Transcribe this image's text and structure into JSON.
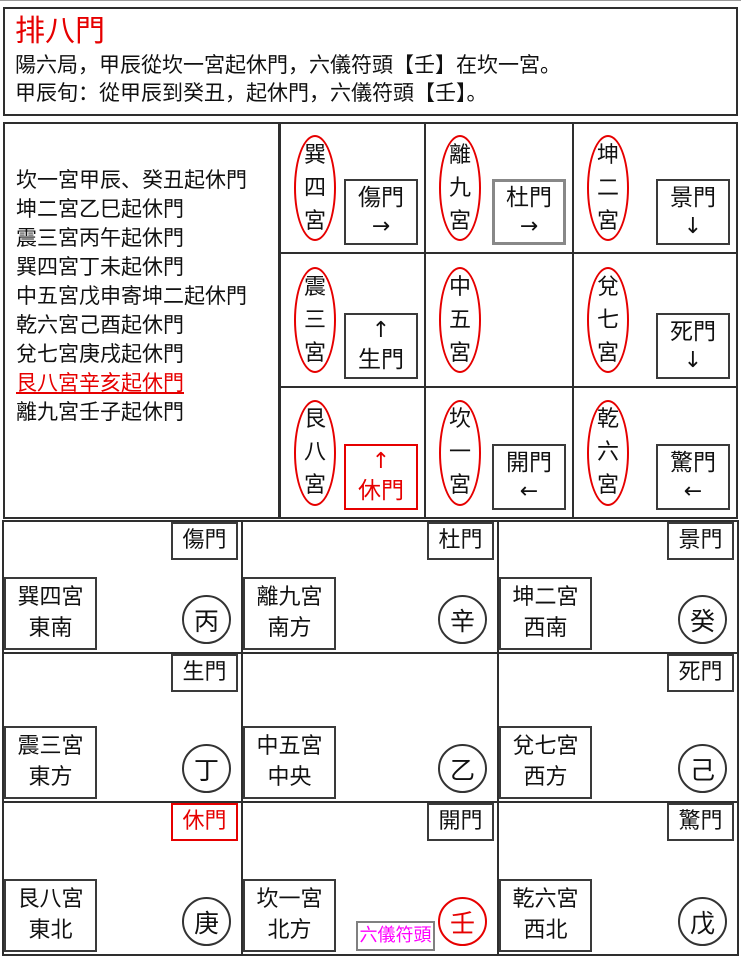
{
  "header": {
    "title": "排八門",
    "line1": "陽六局，甲辰從坎一宮起休門，六儀符頭【壬】在坎一宮。",
    "line2": "甲辰旬：從甲辰到癸丑，起休門，六儀符頭【壬】。"
  },
  "notes": {
    "items": [
      "坎一宮甲辰、癸丑起休門",
      "坤二宮乙巳起休門",
      "震三宮丙午起休門",
      "巽四宮丁未起休門",
      "中五宮戊申寄坤二起休門",
      "乾六宮己酉起休門",
      "兌七宮庚戌起休門",
      "艮八宮辛亥起休門",
      "離九宮壬子起休門"
    ],
    "highlighted_item": "艮八宮辛亥起休門"
  },
  "gate_chart": {
    "cells": [
      {
        "palace": "巽四宮",
        "gate": "傷門",
        "arrow": "→"
      },
      {
        "palace": "離九宮",
        "gate": "杜門",
        "arrow": "→"
      },
      {
        "palace": "坤二宮",
        "gate": "景門",
        "arrow": "↓"
      },
      {
        "palace": "震三宮",
        "gate": "生門",
        "arrow": "↑"
      },
      {
        "palace": "中五宮"
      },
      {
        "palace": "兌七宮",
        "gate": "死門",
        "arrow": "↓"
      },
      {
        "palace": "艮八宮",
        "gate": "休門",
        "arrow": "↑"
      },
      {
        "palace": "坎一宮",
        "gate": "開門",
        "arrow": "←"
      },
      {
        "palace": "乾六宮",
        "gate": "驚門",
        "arrow": "←"
      }
    ],
    "highlighted_gate": "休門"
  },
  "palace_chart": {
    "stem_label": "六儀符頭",
    "cells": [
      {
        "gate": "傷門",
        "palace": "巽四宮",
        "direction": "東南",
        "stem": "丙"
      },
      {
        "gate": "杜門",
        "palace": "離九宮",
        "direction": "南方",
        "stem": "辛"
      },
      {
        "gate": "景門",
        "palace": "坤二宮",
        "direction": "西南",
        "stem": "癸"
      },
      {
        "gate": "生門",
        "palace": "震三宮",
        "direction": "東方",
        "stem": "丁"
      },
      {
        "palace": "中五宮",
        "direction": "中央",
        "stem": "乙"
      },
      {
        "gate": "死門",
        "palace": "兌七宮",
        "direction": "西方",
        "stem": "己"
      },
      {
        "gate": "休門",
        "palace": "艮八宮",
        "direction": "東北",
        "stem": "庚"
      },
      {
        "gate": "開門",
        "palace": "坎一宮",
        "direction": "北方",
        "stem": "壬"
      },
      {
        "gate": "驚門",
        "palace": "乾六宮",
        "direction": "西北",
        "stem": "戊"
      }
    ],
    "highlighted_stem": "壬",
    "highlighted_gate": "休門"
  },
  "colors": {
    "highlight_red": "#e60000",
    "stem_label_magenta": "#ff00ff",
    "line_black": "#2e2e2e"
  }
}
